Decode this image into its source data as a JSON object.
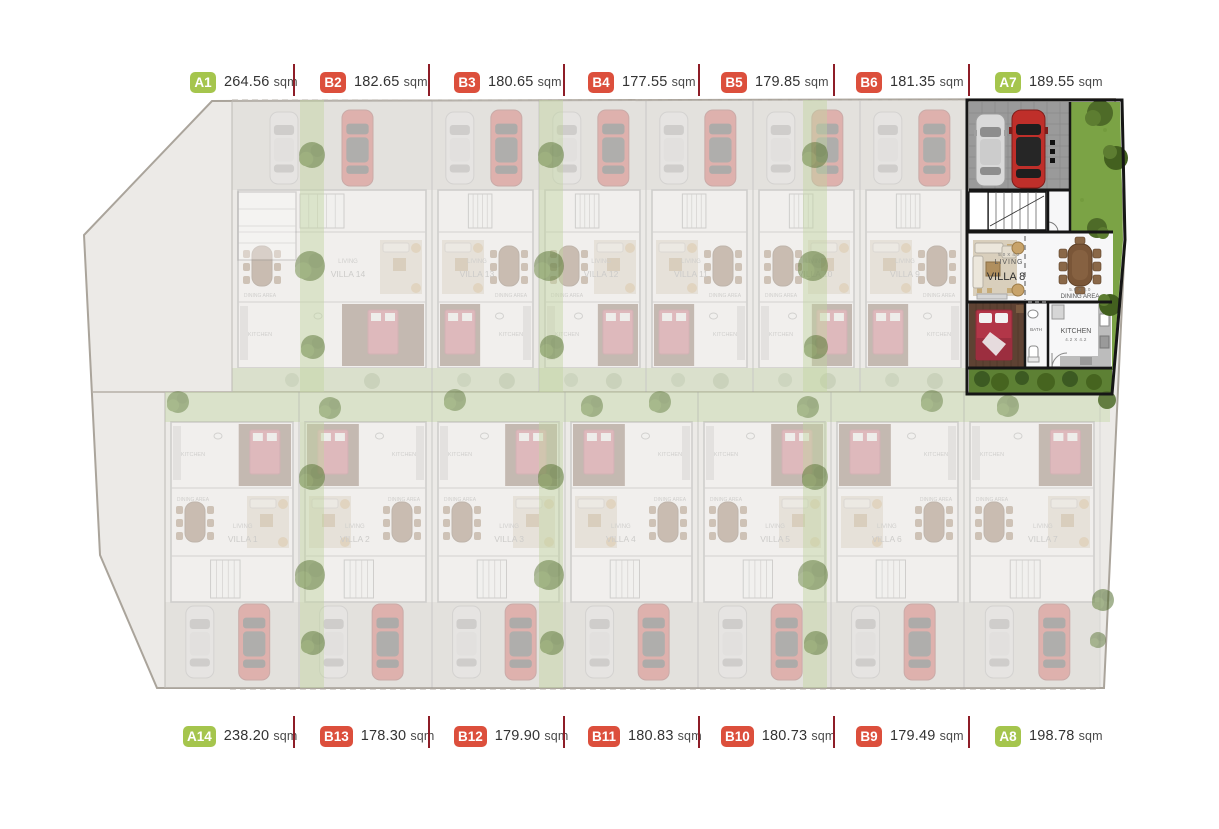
{
  "area_unit": "sqm",
  "top_labels": [
    {
      "code": "A1",
      "area": "264.56",
      "type": "A"
    },
    {
      "code": "B2",
      "area": "182.65",
      "type": "B"
    },
    {
      "code": "B3",
      "area": "180.65",
      "type": "B"
    },
    {
      "code": "B4",
      "area": "177.55",
      "type": "B"
    },
    {
      "code": "B5",
      "area": "179.85",
      "type": "B"
    },
    {
      "code": "B6",
      "area": "181.35",
      "type": "B"
    },
    {
      "code": "A7",
      "area": "189.55",
      "type": "A"
    }
  ],
  "bottom_labels": [
    {
      "code": "A14",
      "area": "238.20",
      "type": "A"
    },
    {
      "code": "B13",
      "area": "178.30",
      "type": "B"
    },
    {
      "code": "B12",
      "area": "179.90",
      "type": "B"
    },
    {
      "code": "B11",
      "area": "180.83",
      "type": "B"
    },
    {
      "code": "B10",
      "area": "180.73",
      "type": "B"
    },
    {
      "code": "B9",
      "area": "179.49",
      "type": "B"
    },
    {
      "code": "A8",
      "area": "198.78",
      "type": "A"
    }
  ],
  "plan": {
    "top_villas": [
      "VILLA 14",
      "VILLA 13",
      "VILLA 12",
      "VILLA 11",
      "VILLA 10",
      "VILLA 9"
    ],
    "bottom_villas": [
      "VILLA 1",
      "VILLA 2",
      "VILLA 3",
      "VILLA 4",
      "VILLA 5",
      "VILLA 6",
      "VILLA 7"
    ],
    "room_labels": {
      "living": "LIVING",
      "dining": "DINING AREA",
      "kitchen": "KITCHEN",
      "bath": "BATH"
    },
    "highlighted": {
      "name": "VILLA 8",
      "living": "LIVING",
      "living_dims": "5.0 X 4.2",
      "dining": "DINING AREA",
      "dining_dims": "5.9 X 4.0",
      "kitchen": "KITCHEN",
      "kitchen_dims": "4.2 X 4.2",
      "bath": "BATH"
    }
  },
  "colors": {
    "badge_a": "#a5c54d",
    "badge_b": "#dc4f3c",
    "divider": "#8e1d27",
    "label_text": "#333333",
    "highlight_wall": "#161616",
    "lawn": "#7ba345",
    "garden": "#5d8034"
  }
}
